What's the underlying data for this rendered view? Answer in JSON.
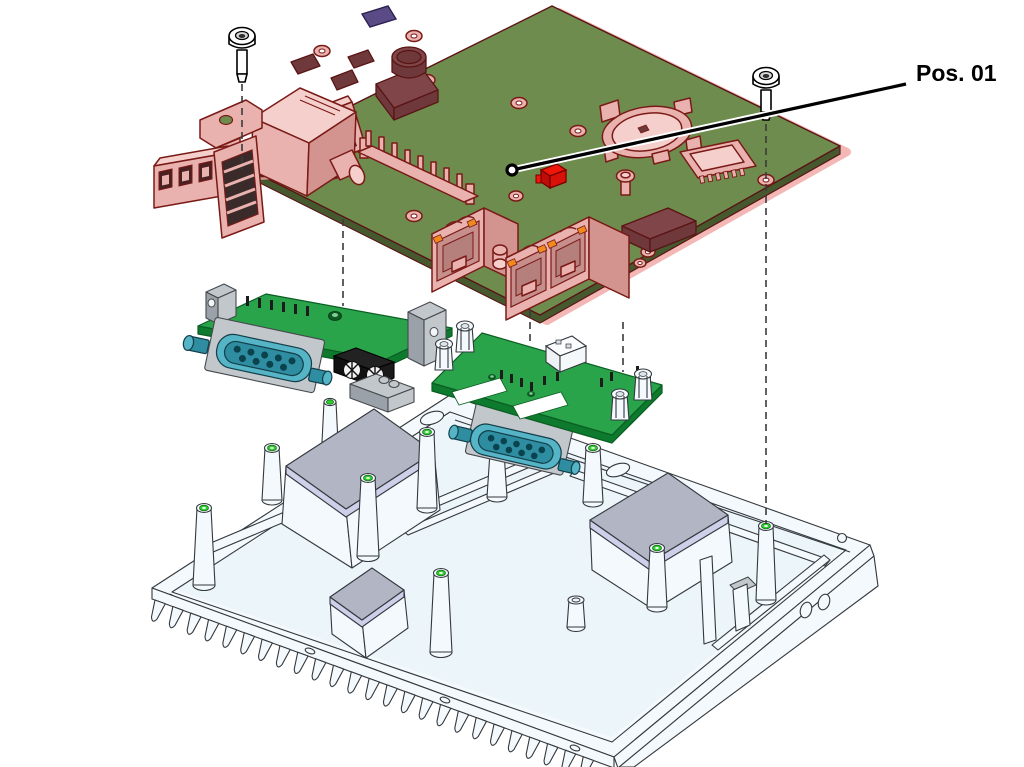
{
  "label": {
    "text": "Pos. 01"
  },
  "palette": {
    "pcb-green": "#6f8c4f",
    "pcb-green-edge": "#46592e",
    "pcb-outline": "#5a1414",
    "hl-pink": "#e9b2ae",
    "hl-pink-light": "#f5cfcc",
    "hl-pink-dark": "#d3948f",
    "hl-glow": "#f3b8b5",
    "hl-outline": "#7a1a17",
    "module-orange": "#f19d20",
    "module-orange-dark": "#d07f0a",
    "part-red": "#ee1509",
    "led-orange": "#f08a1e",
    "chip-maroon": "#6f383b",
    "chip-maroon-light": "#7f4548",
    "daughter-green": "#2aa44a",
    "daughter-green-light": "#3cb35b",
    "daughter-green-edge": "#0e7a2d",
    "teal": "#55b4c6",
    "teal-dark": "#2e8da0",
    "teal-hole": "#0a424e",
    "metal-gray": "#c2c7cc",
    "metal-gray-dark": "#9aa1a8",
    "pad-gray": "#b2b5c3",
    "pad-lavender": "#cdd0e8",
    "chassis-white": "#f3f9fd",
    "chassis-tint": "#ecf5fa",
    "line-dark": "#33383d",
    "green-ring": "#2bd12b"
  }
}
